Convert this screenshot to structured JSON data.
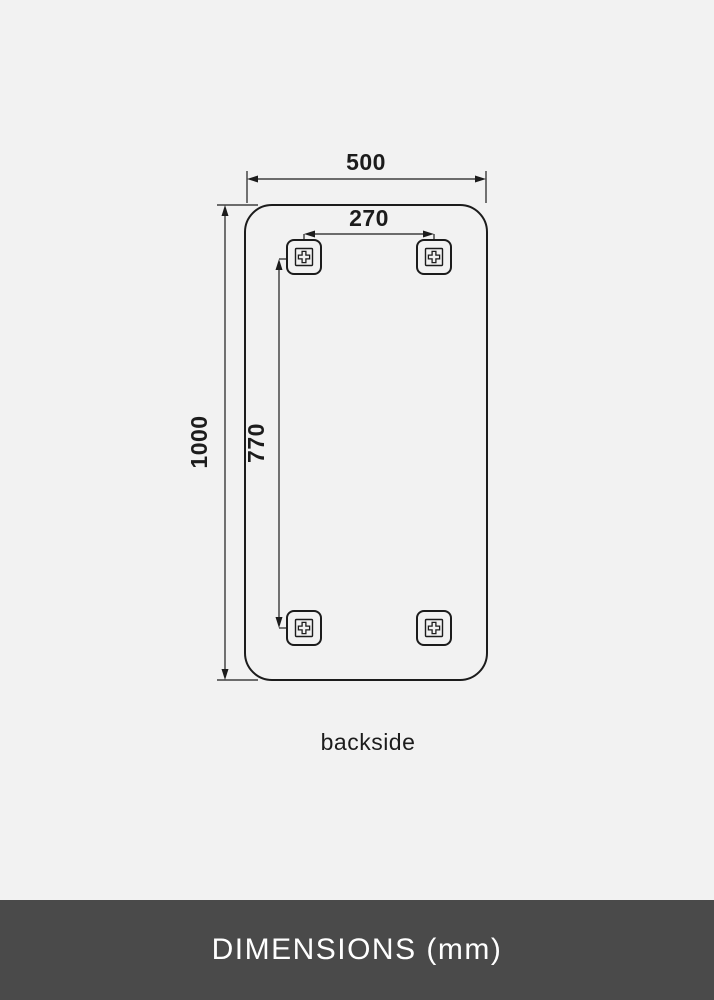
{
  "colors": {
    "background": "#f2f2f2",
    "line": "#1c1c1c",
    "footer_bg": "#4a4a4a",
    "footer_fg": "#ffffff"
  },
  "drawing": {
    "view_label": "backside",
    "unit": "mm",
    "dimensions": {
      "overall_width": "500",
      "overall_height": "1000",
      "bracket_spacing_horizontal": "270",
      "bracket_spacing_vertical": "770"
    }
  },
  "footer": {
    "label": "DIMENSIONS (mm)"
  }
}
